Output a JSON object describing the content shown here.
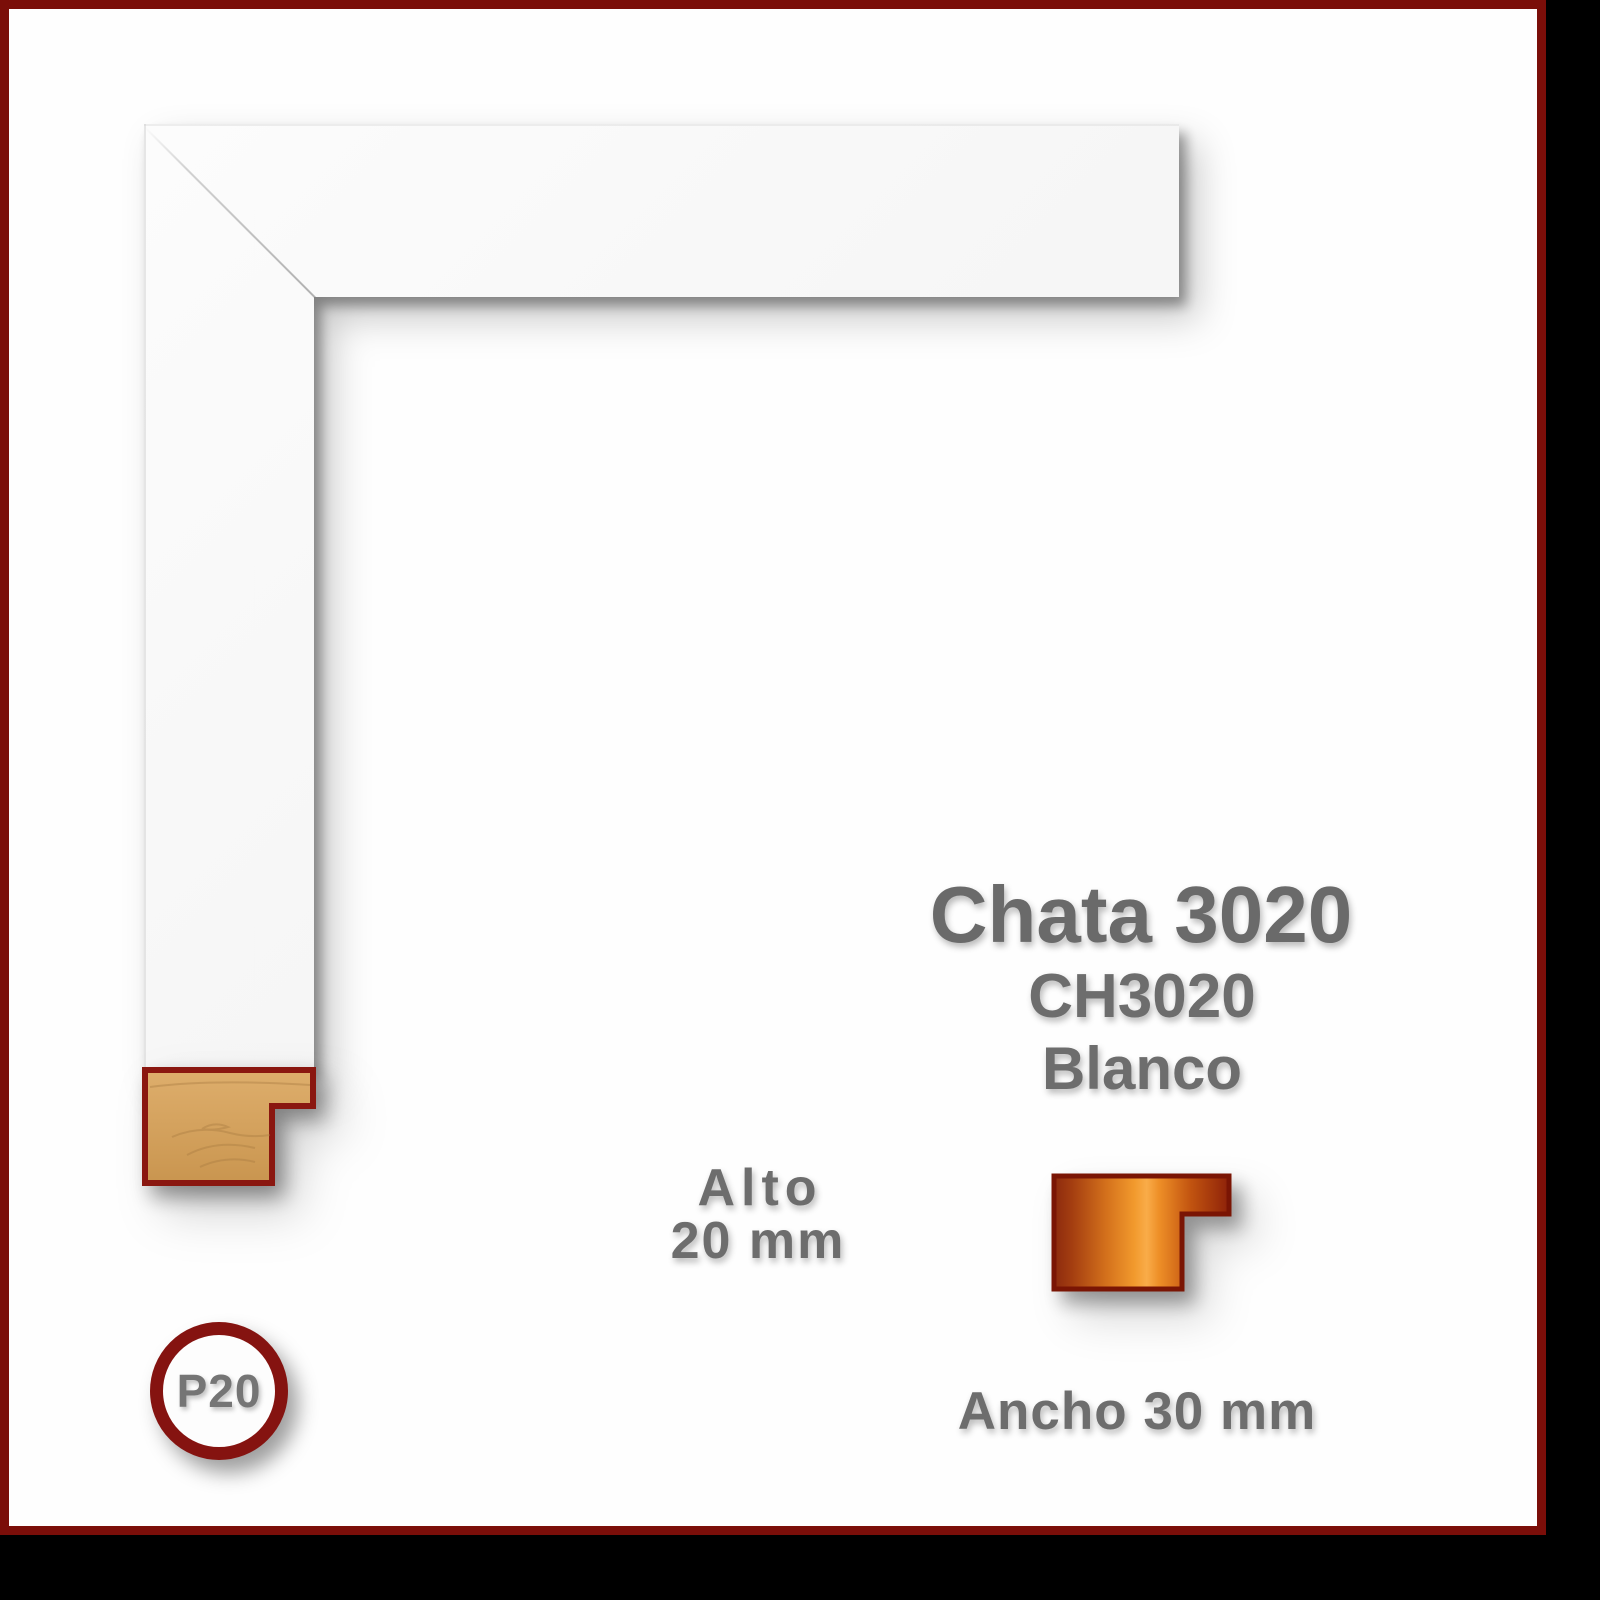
{
  "canvas": {
    "background": "#000000"
  },
  "card": {
    "background": "#fefefe",
    "border_color": "#7b0e09"
  },
  "sample": {
    "description": "white frame moulding corner sample photo",
    "surface_color": "#f7f7f7",
    "wood_color": "#d4a15d",
    "wood_outline_color": "#8a1710"
  },
  "product": {
    "title": "Chata 3020",
    "code": "CH3020",
    "finish": "Blanco"
  },
  "dimensions": {
    "height_label": "Alto",
    "height_value": "20 mm",
    "width_label": "Ancho 30 mm"
  },
  "badge": {
    "label": "P20",
    "ring_color": "#851310",
    "text_color": "#757575"
  },
  "profile_icon": {
    "outline_color": "#7a1504",
    "gradient": [
      "#8c2a0e",
      "#a33d10",
      "#d4711c",
      "#f29a2d",
      "#f9ac49",
      "#ee8f27",
      "#c25410",
      "#8e2209"
    ]
  },
  "text_color": "#6d6d6d"
}
